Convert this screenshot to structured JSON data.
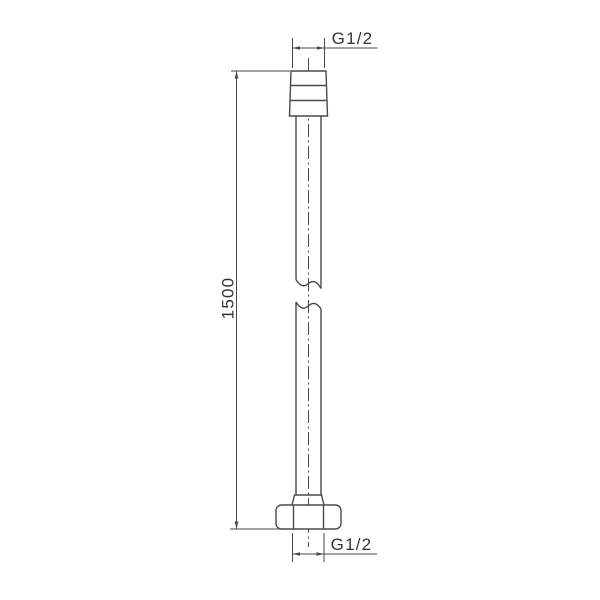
{
  "colors": {
    "line": "#4a4a4a",
    "text": "#333333",
    "background": "#ffffff"
  },
  "labels": {
    "top_thread": "G1/2",
    "length": "1500",
    "bottom_thread": "G1/2"
  }
}
